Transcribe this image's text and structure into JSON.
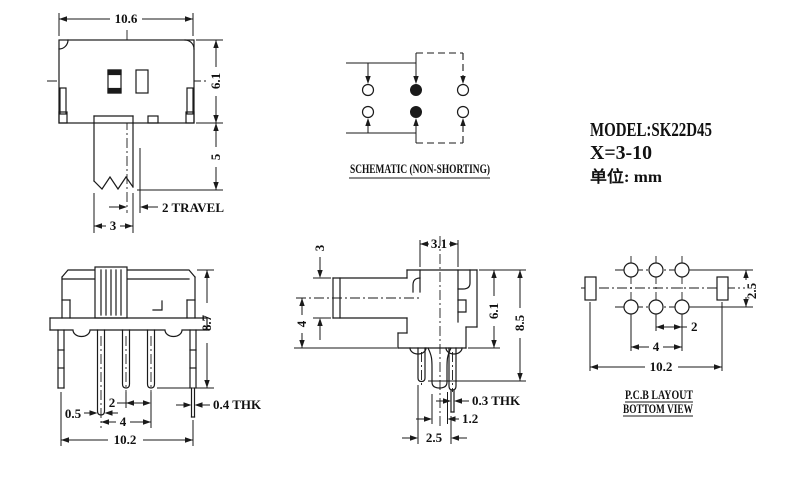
{
  "colors": {
    "line": "#1a1a1a",
    "background": "#ffffff"
  },
  "title_block": {
    "model": "MODEL:SK22D45",
    "x_range": "X=3-10",
    "unit": "单位: mm"
  },
  "views": {
    "front": {
      "dims": {
        "width": "10.6",
        "body_height": "6.1",
        "stem_height": "5",
        "travel": "2 TRAVEL",
        "stem_width": "3"
      }
    },
    "schematic": {
      "title": "SCHEMATIC (NON-SHORTING)"
    },
    "side": {
      "dims": {
        "overall_height": "8.7",
        "pin_width": "0.5",
        "pin_pitch": "2",
        "pin_span": "4",
        "overall_width": "10.2",
        "thickness": "0.4 THK"
      }
    },
    "end": {
      "dims": {
        "knob_height": "3",
        "body_width": "3.1",
        "knob_offset": "4",
        "body_height": "6.1",
        "overall_height": "8.5",
        "thickness": "0.3 THK",
        "tab_width": "1.2",
        "pin_spacing": "2.5"
      }
    },
    "pcb": {
      "title": "P.C.B LAYOUT",
      "subtitle": "BOTTOM VIEW",
      "dims": {
        "row_pitch": "2.5",
        "hole_pitch": "2",
        "hole_span": "4",
        "overall_width": "10.2"
      }
    }
  }
}
